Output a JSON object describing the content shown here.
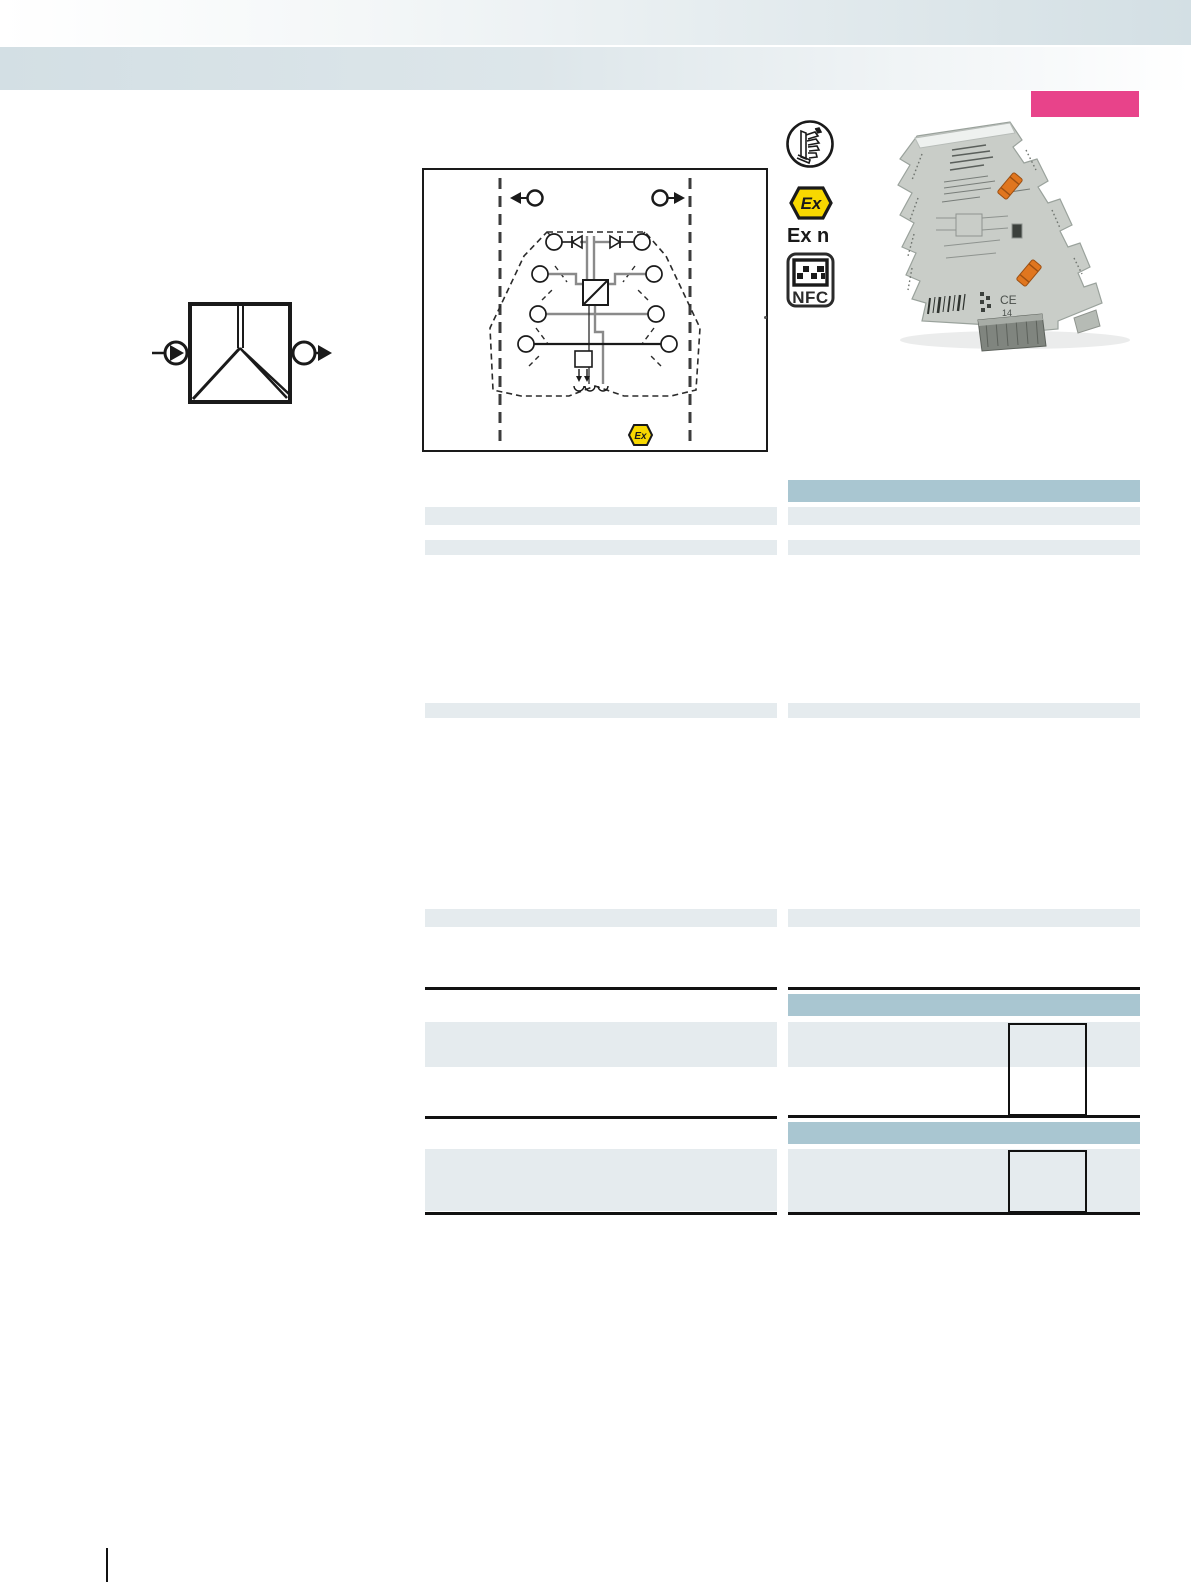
{
  "page": {
    "width": 1191,
    "height": 1582,
    "background": "#ffffff"
  },
  "header": {
    "gradient_color": "#d3dfe4",
    "badge_color": "#e8438a"
  },
  "approvals": {
    "connection_icon": "push-in-connector",
    "ex_hex_label": "Ex",
    "ex_n_label": "Ex n",
    "nfc_label": "NFC"
  },
  "diagram": {
    "input_symbol": "arrow-left-circle",
    "output_symbol": "circle-arrow-right",
    "ex_hex_label": "Ex"
  },
  "product_photo": {
    "ce_mark": "CE",
    "ce_number": "14"
  },
  "colors": {
    "table_header": "#a9c6d1",
    "table_row": "#e5ebee",
    "rule": "#111111",
    "badge_pink": "#e8438a",
    "ex_yellow": "#f8d800",
    "clip_orange": "#e0761f",
    "module_gray": "#c9cdc8"
  },
  "tables": {
    "left": {
      "bands": [
        {
          "type": "row",
          "top": 507,
          "h": 18
        },
        {
          "type": "row",
          "top": 540,
          "h": 15
        },
        {
          "type": "row",
          "top": 703,
          "h": 15
        },
        {
          "type": "row",
          "top": 909,
          "h": 18
        },
        {
          "type": "rule",
          "top": 987,
          "h": 3
        },
        {
          "type": "row",
          "top": 1022,
          "h": 45
        },
        {
          "type": "rule",
          "top": 1116,
          "h": 3
        },
        {
          "type": "row",
          "top": 1149,
          "h": 62
        },
        {
          "type": "rule",
          "top": 1212,
          "h": 3
        }
      ]
    },
    "right": {
      "bands": [
        {
          "type": "header",
          "top": 480,
          "h": 22
        },
        {
          "type": "row",
          "top": 507,
          "h": 18
        },
        {
          "type": "row",
          "top": 540,
          "h": 15
        },
        {
          "type": "row",
          "top": 703,
          "h": 15
        },
        {
          "type": "row",
          "top": 909,
          "h": 18
        },
        {
          "type": "rule",
          "top": 987,
          "h": 3
        },
        {
          "type": "header",
          "top": 994,
          "h": 22
        },
        {
          "type": "row",
          "top": 1022,
          "h": 45
        },
        {
          "type": "rule",
          "top": 1115,
          "h": 3
        },
        {
          "type": "header",
          "top": 1122,
          "h": 22
        },
        {
          "type": "row",
          "top": 1149,
          "h": 64
        },
        {
          "type": "rule",
          "top": 1212,
          "h": 3
        }
      ],
      "boxes": [
        {
          "left": 1008,
          "top": 1023,
          "w": 79,
          "h": 93
        },
        {
          "left": 1008,
          "top": 1150,
          "w": 79,
          "h": 63
        }
      ]
    }
  }
}
